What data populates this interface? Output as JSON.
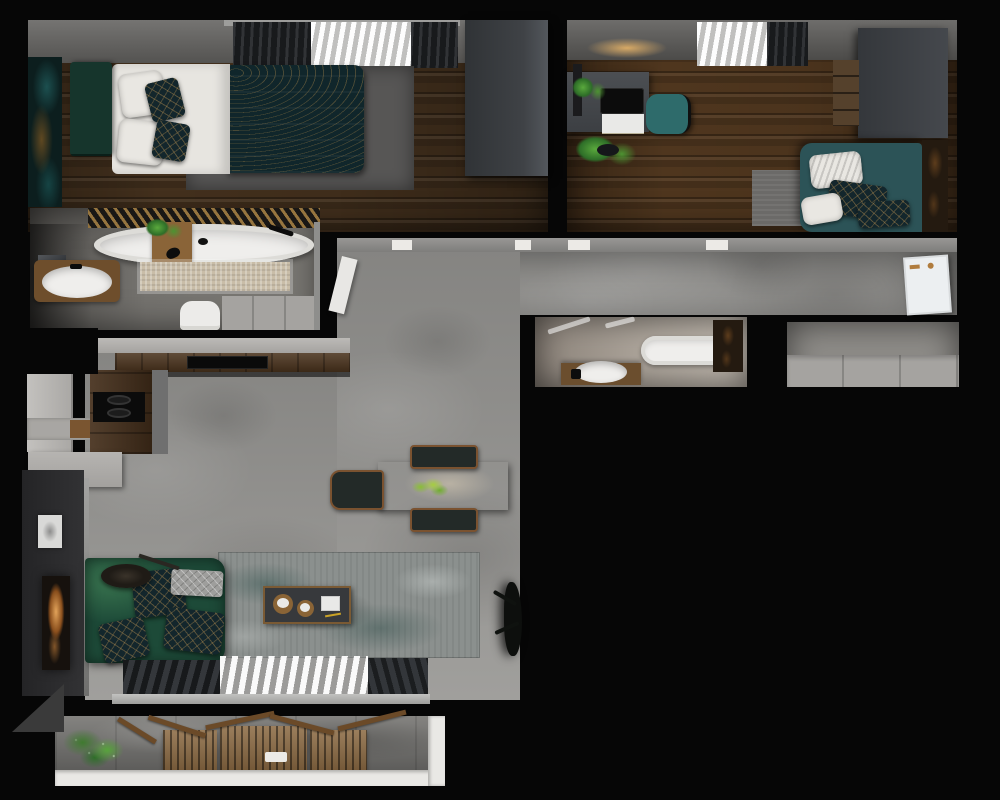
{
  "scene": {
    "name": "apartment-floor-plan-render",
    "description": "top-down 3D architectural render of a one-level apartment, no text labels visible",
    "background": "#060606"
  },
  "palette": {
    "walls_black": "#060606",
    "wood_floor_a": "#43301d",
    "wood_floor_b": "#4f361e",
    "concrete_floor": "#9b9a97",
    "tile_bath_large": "#706e6a",
    "tile_bath_small": "#a89f95",
    "duvet_teal": "#10262b",
    "headboard_green": "#16352c",
    "daybed_teal": "#2c5357",
    "chair_teal": "#2e6b6b",
    "sofa_green": "#1d4a38",
    "white_fixture": "#efeeec",
    "door_white": "#eceff1",
    "sheer_white": "#dcdbd9",
    "curtain_dark": "#202225",
    "rug_runner_beige": "#c9bda8",
    "rug_living_gray_teal": "#8b908e",
    "rug_bedroom_gray": "#575655",
    "cabinet_gray": "#a5a3a0",
    "counter_wood": "#4a331d",
    "wardrobe_dark": "#3a3d41",
    "balcony_wood": "#8a6840",
    "fire_glow_amber": "#b97b33",
    "plant_green": "#3f7a2f",
    "rail_white": "#e9e8e5"
  },
  "rooms": {
    "bedroom1": {
      "label": "bedroom with double bed",
      "furniture": [
        "double-bed",
        "green-headboard",
        "teal-patterned-duvet",
        "white-pillows",
        "gray-area-rug",
        "wardrobe",
        "teal-wall-art",
        "window-curtains"
      ]
    },
    "bedroom2": {
      "label": "bedroom office",
      "furniture": [
        "desk",
        "laptop",
        "white-drawer-unit",
        "desk-plant",
        "teal-desk-chair",
        "floor-plant",
        "wardrobe",
        "wood-drawer-cabinet",
        "teal-daybed",
        "pillows",
        "small-rug",
        "window-curtains"
      ]
    },
    "bathroom1": {
      "label": "large bathroom",
      "furniture": [
        "freestanding-oval-bathtub",
        "wood-slat-accent-wall",
        "beige-runner-rug",
        "round-sink",
        "mirror",
        "wood-stool-with-plant",
        "toilet",
        "gray-cabinet"
      ]
    },
    "bathroom2": {
      "label": "small bathroom",
      "furniture": [
        "bathtub",
        "wood-vanity",
        "round-sink",
        "dark-wood-shelf"
      ]
    },
    "living": {
      "label": "living room",
      "furniture": [
        "green-sofa",
        "patterned-pillows",
        "floor-lamp",
        "coffee-table",
        "teal-gray-rug",
        "fireplace",
        "wall-picture",
        "dark-plant",
        "window-curtains"
      ]
    },
    "kitchen": {
      "label": "kitchen",
      "furniture": [
        "wood-counter",
        "induction-hob",
        "cooktop-with-burners",
        "fridge",
        "island-cabinet",
        "cutting-board"
      ]
    },
    "dining": {
      "label": "dining area",
      "furniture": [
        "wood-dining-table",
        "plant-centerpiece",
        "three-chairs"
      ]
    },
    "hallway": {
      "label": "entrance hallway",
      "furniture": [
        "white-entrance-door",
        "open-bathroom-door"
      ]
    },
    "storage": {
      "label": "wardrobe storage room",
      "furniture": [
        "gray-wardrobe-cabinets"
      ]
    },
    "balcony": {
      "label": "balcony",
      "furniture": [
        "wood-slat-furniture",
        "planter-with-white-flowers",
        "white-railing"
      ]
    }
  }
}
